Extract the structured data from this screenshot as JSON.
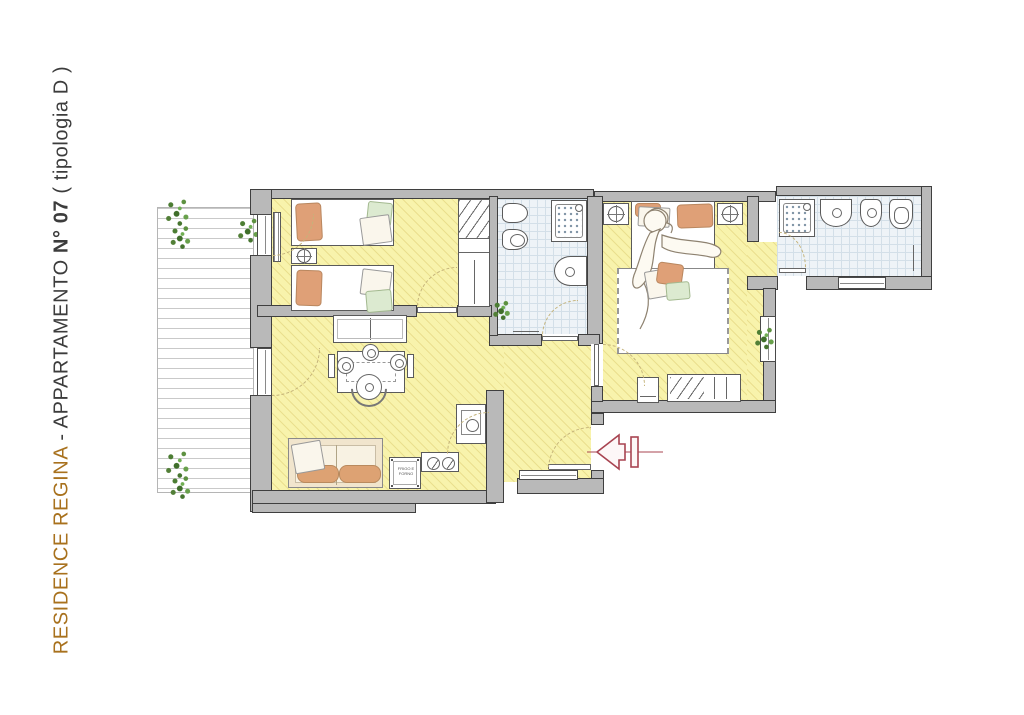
{
  "title": {
    "residence": "RESIDENCE REGINA",
    "middle": " - APPARTAMENTO ",
    "number": "N° 07",
    "typology": " ( tipologia D )"
  },
  "kitchen": {
    "appliance_label": "FRIGO E FORNO"
  },
  "symbols": {
    "entrance_arrow": "arrow pointing left to entrance door",
    "plant": "green shrub marker",
    "shower": "square with dot grid",
    "lamp": "circle with crosshair"
  },
  "colors": {
    "title_brown": "#a8711d",
    "title_dark": "#3c3c3c",
    "wall_fill": "#b9b9b9",
    "wall_outline": "#3f3f3f",
    "floor_yellow": "#f8f3ac",
    "floor_hatch": "#eadf8e",
    "tile_blue": "#eef3f7",
    "tile_grid": "#d3dfe8",
    "furniture_outline": "#5a5a5a",
    "pillow_orange": "#dfa077",
    "blanket_green": "#dcead0",
    "sofa_beige": "#f1e5cd",
    "cushion_orange": "#dda273",
    "plant_green": "#53803a",
    "terrace_line": "#c9c9c9",
    "door_arc": "#c4b37a",
    "arrow_red": "#a84451"
  }
}
